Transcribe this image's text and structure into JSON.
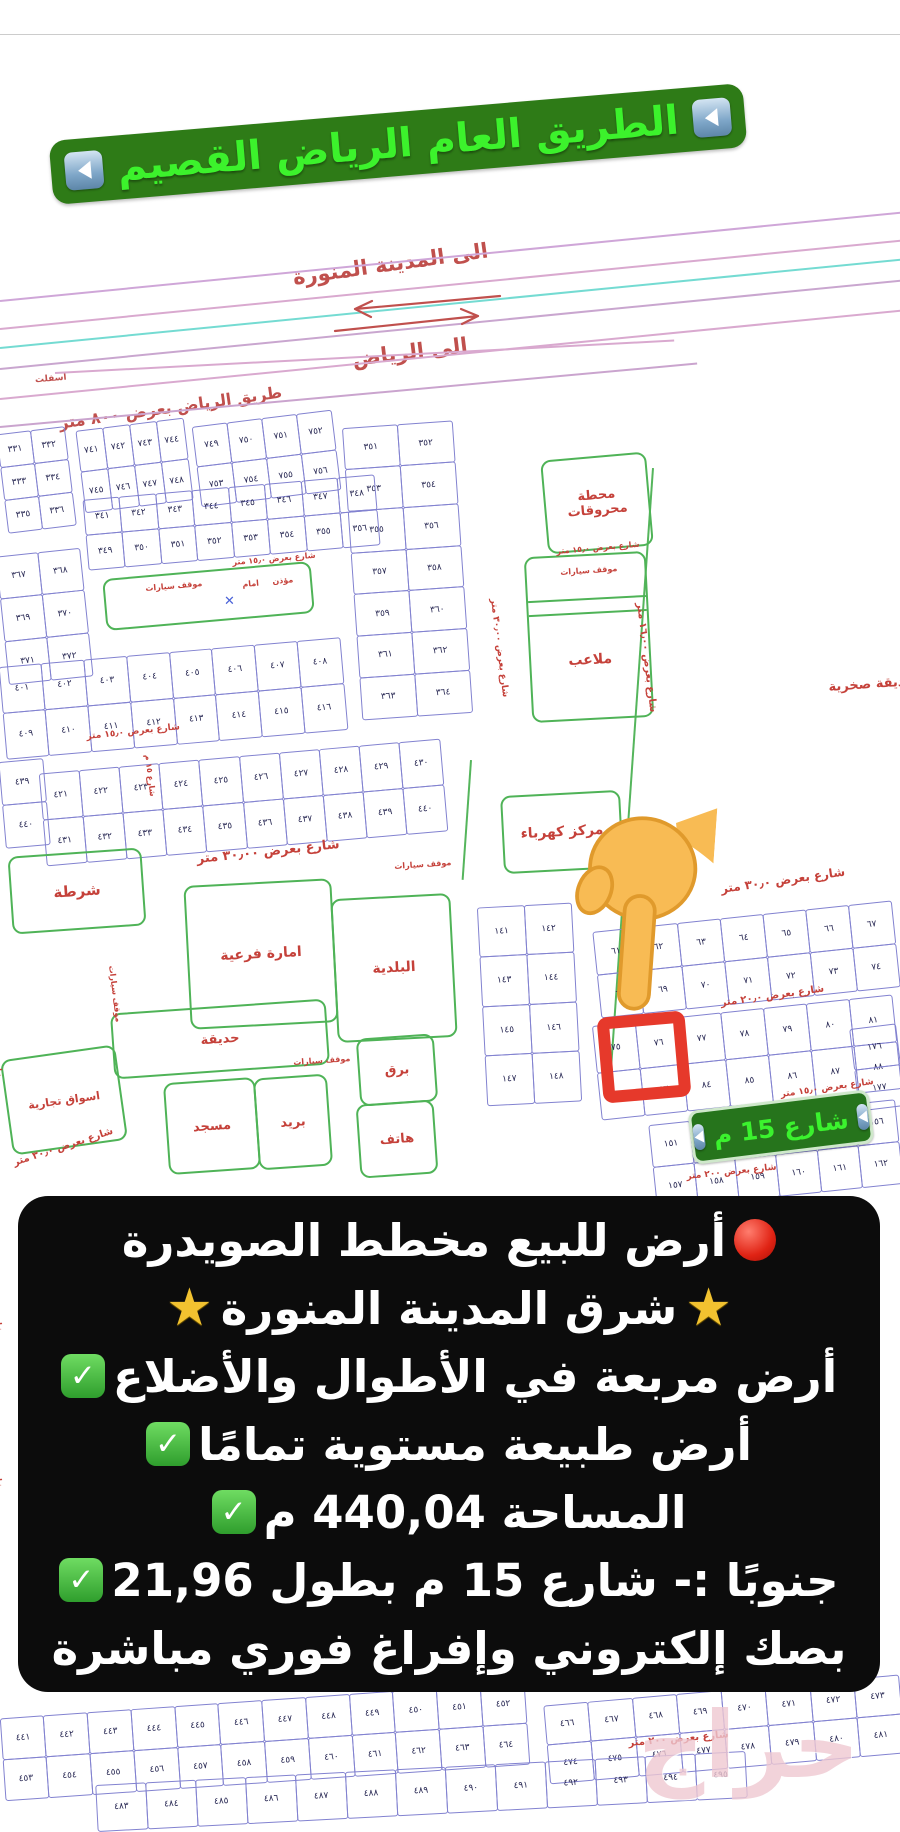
{
  "banner": {
    "text": "الطريق العام الرياض القصيم",
    "arrow_icon": "blue-left-arrow"
  },
  "directions": {
    "madinah": "الى المدينة المنورة",
    "riyadh": "الى الرياض",
    "asphalt": "اسفلت",
    "riyadh_road": "طريق الرياض بعرض ٨٠٠ متر"
  },
  "highlight": {
    "street_pill": "شارع 15 م"
  },
  "watermark": "حراج",
  "colors": {
    "banner_bg": "#2e7b17",
    "banner_text": "#3cf22c",
    "map_red": "#c5413a",
    "plot_blue": "#8282d0",
    "facility_green": "#4fb357",
    "pill_bg": "#26741c",
    "overlay_bg": "#0c0c0c",
    "highlight_red": "#e6392b",
    "hand_yellow": "#f8bb54",
    "road_pink": "#d9a9cf",
    "road_cyan": "#74dbd2"
  },
  "overlay": {
    "lines": [
      {
        "segments": [
          {
            "type": "icon",
            "value": "red-circle"
          },
          {
            "type": "text",
            "value": "أرض للبيع مخطط الصويدرة"
          }
        ]
      },
      {
        "segments": [
          {
            "type": "icon",
            "value": "star"
          },
          {
            "type": "text",
            "value": "شرق المدينة المنورة "
          },
          {
            "type": "icon",
            "value": "star"
          }
        ]
      },
      {
        "segments": [
          {
            "type": "text",
            "value": "أرض مربعة في الأطوال والأضلاع"
          },
          {
            "type": "icon",
            "value": "check"
          }
        ]
      },
      {
        "segments": [
          {
            "type": "text",
            "value": "أرض طبيعة مستوية تمامًا "
          },
          {
            "type": "icon",
            "value": "check"
          }
        ]
      },
      {
        "segments": [
          {
            "type": "text",
            "value": "المساحة 440,04 م"
          },
          {
            "type": "icon",
            "value": "check"
          }
        ]
      },
      {
        "segments": [
          {
            "type": "text",
            "value": "جنوبًا :- شارع 15 م بطول 21,96"
          },
          {
            "type": "icon",
            "value": "check"
          }
        ]
      },
      {
        "segments": [
          {
            "type": "text",
            "value": "بصك إلكتروني وإفراغ فوري مباشرة"
          }
        ]
      }
    ]
  },
  "map": {
    "road_lines": [
      {
        "x": 0,
        "y": 300,
        "len": 950,
        "rot": -5.6,
        "color": "#cfa6d8"
      },
      {
        "x": 0,
        "y": 328,
        "len": 950,
        "rot": -5.6,
        "color": "#d9a9cf"
      },
      {
        "x": 0,
        "y": 347,
        "len": 950,
        "rot": -5.6,
        "color": "#74dbd2"
      },
      {
        "x": 0,
        "y": 368,
        "len": 950,
        "rot": -5.6,
        "color": "#c9a6cf"
      },
      {
        "x": 0,
        "y": 398,
        "len": 950,
        "rot": -5.6,
        "color": "#d9a9cf"
      },
      {
        "x": 0,
        "y": 426,
        "len": 700,
        "rot": -5.2,
        "color": "#caa4ce"
      },
      {
        "x": 55,
        "y": 372,
        "len": 620,
        "rot": -3.0,
        "color": "#d9a9cf"
      }
    ],
    "green_lines": [
      {
        "x": 652,
        "y": 468,
        "len": 600,
        "rot": 86
      },
      {
        "x": 470,
        "y": 760,
        "len": 120,
        "rot": 86
      }
    ],
    "grids": [
      {
        "id": "g1",
        "x": 2,
        "y": 430,
        "w": 68,
        "h": 100,
        "r": 3,
        "c": 2,
        "rot": -7,
        "start": 331
      },
      {
        "id": "g2",
        "x": 80,
        "y": 424,
        "w": 108,
        "h": 82,
        "r": 2,
        "c": 4,
        "rot": -7,
        "start": 741
      },
      {
        "id": "g3",
        "x": 196,
        "y": 418,
        "w": 140,
        "h": 80,
        "r": 2,
        "c": 4,
        "rot": -7,
        "start": 749
      },
      {
        "id": "g4",
        "x": 352,
        "y": 424,
        "w": 110,
        "h": 292,
        "r": 7,
        "c": 2,
        "rot": -4,
        "start": 351
      },
      {
        "id": "g5",
        "x": 85,
        "y": 487,
        "w": 292,
        "h": 70,
        "r": 2,
        "c": 8,
        "rot": -5,
        "start": 341
      },
      {
        "id": "g6",
        "x": 2,
        "y": 552,
        "w": 84,
        "h": 128,
        "r": 3,
        "c": 2,
        "rot": -6,
        "start": 367
      },
      {
        "id": "g7",
        "x": 2,
        "y": 652,
        "w": 342,
        "h": 92,
        "r": 2,
        "c": 8,
        "rot": -5,
        "start": 401
      },
      {
        "id": "g8",
        "x": 42,
        "y": 756,
        "w": 402,
        "h": 92,
        "r": 2,
        "c": 10,
        "rot": -5,
        "start": 421
      },
      {
        "id": "g9",
        "x": 2,
        "y": 760,
        "w": 44,
        "h": 86,
        "r": 2,
        "c": 1,
        "rot": -5,
        "start": 439
      },
      {
        "id": "g10",
        "x": 482,
        "y": 905,
        "w": 94,
        "h": 198,
        "r": 4,
        "c": 2,
        "rot": -3,
        "start": 141
      },
      {
        "id": "g11",
        "x": 596,
        "y": 916,
        "w": 300,
        "h": 86,
        "r": 2,
        "c": 7,
        "rot": -6,
        "start": 61
      },
      {
        "id": "g12",
        "x": 596,
        "y": 1010,
        "w": 302,
        "h": 94,
        "r": 2,
        "c": 7,
        "rot": -6,
        "start": 75
      },
      {
        "id": "g13",
        "x": 652,
        "y": 1112,
        "w": 248,
        "h": 84,
        "r": 2,
        "c": 6,
        "rot": -6,
        "start": 151
      },
      {
        "id": "g14",
        "x": 854,
        "y": 1026,
        "w": 46,
        "h": 82,
        "r": 2,
        "c": 1,
        "rot": -7,
        "start": 176
      },
      {
        "id": "g15",
        "x": 2,
        "y": 1700,
        "w": 525,
        "h": 82,
        "r": 2,
        "c": 12,
        "rot": -4,
        "start": 441
      },
      {
        "id": "g16",
        "x": 546,
        "y": 1690,
        "w": 356,
        "h": 78,
        "r": 2,
        "c": 8,
        "rot": -5,
        "start": 466
      },
      {
        "id": "g17",
        "x": 96,
        "y": 1768,
        "w": 650,
        "h": 46,
        "r": 1,
        "c": 13,
        "rot": -3,
        "start": 483
      }
    ],
    "facilities": [
      {
        "id": "fuel-station",
        "label": "محطة محروقات",
        "x": 544,
        "y": 456,
        "w": 102,
        "h": 90,
        "rot": -5,
        "fs": 13
      },
      {
        "id": "parking-playground",
        "label": "ملاعب",
        "x": 528,
        "y": 554,
        "w": 118,
        "h": 162,
        "rot": -3,
        "fs": 14
      },
      {
        "id": "electricity-center",
        "label": "مركز كهرباء",
        "x": 502,
        "y": 793,
        "w": 116,
        "h": 74,
        "rot": -3,
        "fs": 14
      },
      {
        "id": "police",
        "label": "شرطة",
        "x": 10,
        "y": 852,
        "w": 130,
        "h": 74,
        "rot": -4,
        "fs": 15
      },
      {
        "id": "sub-emirate",
        "label": "امارة فرعية",
        "x": 187,
        "y": 882,
        "w": 144,
        "h": 140,
        "rot": -3,
        "fs": 14
      },
      {
        "id": "municipality",
        "label": "البلدية",
        "x": 334,
        "y": 896,
        "w": 116,
        "h": 140,
        "rot": -3,
        "fs": 14
      },
      {
        "id": "garden",
        "label": "حديقة",
        "x": 112,
        "y": 1006,
        "w": 212,
        "h": 62,
        "rot": -4,
        "fs": 13
      },
      {
        "id": "mosque",
        "label": "مسجد",
        "x": 166,
        "y": 1080,
        "w": 88,
        "h": 88,
        "rot": -4,
        "fs": 13
      },
      {
        "id": "post-office",
        "label": "بريد",
        "x": 256,
        "y": 1076,
        "w": 70,
        "h": 88,
        "rot": -4,
        "fs": 13
      },
      {
        "id": "telegraph",
        "label": "برق",
        "x": 358,
        "y": 1036,
        "w": 74,
        "h": 64,
        "rot": -4,
        "fs": 13
      },
      {
        "id": "telephone",
        "label": "هاتف",
        "x": 358,
        "y": 1102,
        "w": 74,
        "h": 70,
        "rot": -4,
        "fs": 13
      },
      {
        "id": "commercial-markets",
        "label": "اسواق تجارية",
        "x": 6,
        "y": 1052,
        "w": 112,
        "h": 92,
        "rot": -8,
        "fs": 11
      },
      {
        "id": "mosque-annex",
        "label": "",
        "x": 104,
        "y": 570,
        "w": 205,
        "h": 48,
        "rot": -5,
        "fs": 0
      }
    ],
    "street_labels": [
      {
        "t": "شارع بعرض ١٥٫٠ متر",
        "x": 86,
        "y": 732,
        "rot": -6,
        "fs": 9,
        "vert": false
      },
      {
        "t": "شارع بعرض ٣٠٫٠٠ متر",
        "x": 196,
        "y": 852,
        "rot": -6,
        "fs": 13,
        "vert": false
      },
      {
        "t": "شارع بعرض ١٥٫٠ متر",
        "x": 232,
        "y": 558,
        "rot": -5,
        "fs": 8,
        "vert": false
      },
      {
        "t": "شارع بعرض ١٥٫٠ متر",
        "x": 556,
        "y": 547,
        "rot": -5,
        "fs": 8,
        "vert": false
      },
      {
        "t": "موقف سيارات",
        "x": 560,
        "y": 568,
        "rot": -4,
        "fs": 8,
        "vert": false
      },
      {
        "t": "شارع بعرض ٣٠٫٠٠ متر",
        "x": 498,
        "y": 598,
        "rot": 83,
        "fs": 9,
        "vert": true
      },
      {
        "t": "شارع بعرض ١٦٫٠٠ متر",
        "x": 645,
        "y": 602,
        "rot": 83,
        "fs": 10,
        "vert": true
      },
      {
        "t": "شارع بعرض ٣٠٫٠ متر",
        "x": 720,
        "y": 882,
        "rot": -8,
        "fs": 12,
        "vert": false
      },
      {
        "t": "شارع بعرض ٢٠٫٠ متر",
        "x": 720,
        "y": 998,
        "rot": -8,
        "fs": 10,
        "vert": false
      },
      {
        "t": "شارع بعرض ١٥٫٠ متر",
        "x": 780,
        "y": 1090,
        "rot": -8,
        "fs": 9,
        "vert": false
      },
      {
        "t": "شارع بعرض ٢٠٠ متر",
        "x": 686,
        "y": 1172,
        "rot": -6,
        "fs": 9,
        "vert": false
      },
      {
        "t": "شارع بعرض ٣٠٫٠ متر",
        "x": 12,
        "y": 1158,
        "rot": -18,
        "fs": 10,
        "vert": false
      },
      {
        "t": "شارع بعرض ٢٠٠ متر",
        "x": 628,
        "y": 1738,
        "rot": -5,
        "fs": 10,
        "vert": false
      },
      {
        "t": "شارع ١٥ م",
        "x": 152,
        "y": 754,
        "rot": 83,
        "fs": 8,
        "vert": true
      },
      {
        "t": "موقف سيارات",
        "x": 394,
        "y": 862,
        "rot": -4,
        "fs": 8,
        "vert": false
      },
      {
        "t": "موقف سيارات",
        "x": 116,
        "y": 965,
        "rot": 83,
        "fs": 8,
        "vert": true
      },
      {
        "t": "موقف سيارات",
        "x": 293,
        "y": 1058,
        "rot": -4,
        "fs": 8,
        "vert": false
      },
      {
        "t": "حديقة صخرية",
        "x": 828,
        "y": 680,
        "rot": -4,
        "fs": 13,
        "vert": false
      },
      {
        "t": "موقف سيارات",
        "x": 145,
        "y": 584,
        "rot": -5,
        "fs": 8,
        "vert": false
      },
      {
        "t": "امام",
        "x": 242,
        "y": 580,
        "rot": -5,
        "fs": 8,
        "vert": false
      },
      {
        "t": "مؤذن",
        "x": 272,
        "y": 577,
        "rot": -5,
        "fs": 8,
        "vert": false
      },
      {
        "t": "شارع",
        "x": 2,
        "y": 1058,
        "rot": 85,
        "fs": 8,
        "vert": true
      },
      {
        "t": "شارع",
        "x": 2,
        "y": 1312,
        "rot": 85,
        "fs": 8,
        "vert": true
      },
      {
        "t": "شارع",
        "x": 2,
        "y": 1468,
        "rot": 85,
        "fs": 8,
        "vert": true
      }
    ]
  }
}
